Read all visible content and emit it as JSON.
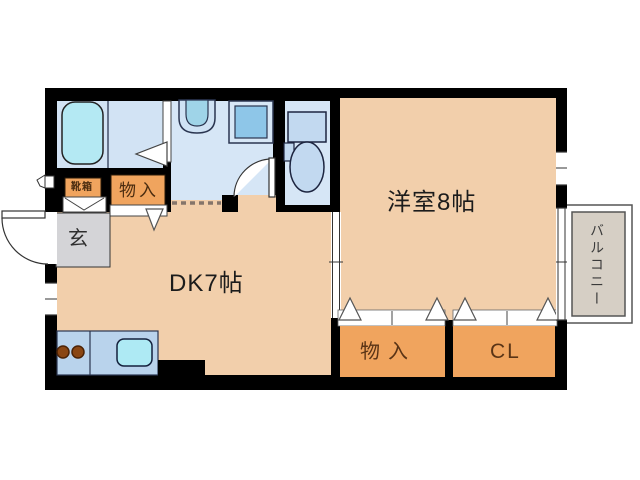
{
  "page": {
    "type": "apartment-floor-plan"
  },
  "rooms": {
    "western_room": {
      "label": "洋室8帖"
    },
    "dining_kitchen": {
      "label": "DK7帖"
    },
    "storage_bottom": {
      "label": "物入"
    },
    "closet": {
      "label": "CL"
    },
    "balcony": {
      "label": "バルコニー"
    },
    "entrance": {
      "label": "玄"
    },
    "shoe_box": {
      "label": "靴箱"
    },
    "storage_top": {
      "label": "物入"
    }
  },
  "fixtures": {
    "bathtub": "bathtub",
    "washbasin": "washbasin",
    "washing_machine": "washing-machine-pan",
    "toilet": "toilet",
    "kitchen_sink": "kitchen-sink",
    "stove_burners": "stove-burners"
  },
  "colors": {
    "wall": "#000000",
    "floor_peach": "#f2cfab",
    "wet_room_blue": "#d6e6f6",
    "tub_cyan": "#b4e9f3",
    "closet_orange": "#f0a45e",
    "entrance_gray": "#d4d4d7",
    "balcony_gray": "#d6cfc5",
    "counter_blue": "#b9d3ec",
    "sink_cyan": "#aeeaf4",
    "burner_brown": "#8a4613"
  }
}
